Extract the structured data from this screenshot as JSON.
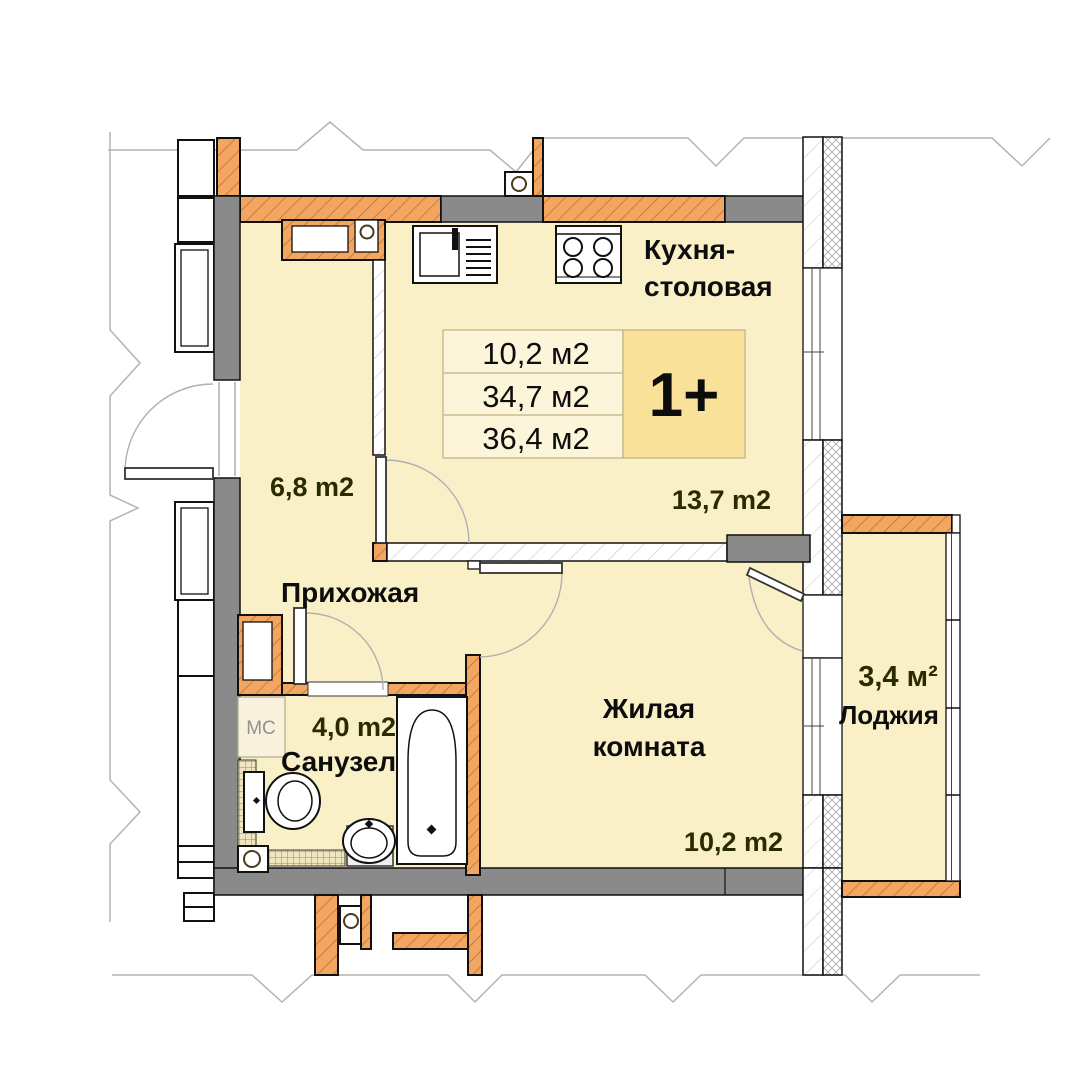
{
  "floor_plan": {
    "unit": {
      "badge": "1+",
      "stats": [
        "10,2 м2",
        "34,7 м2",
        "36,4 м2"
      ]
    },
    "rooms": {
      "kitchen_dining": {
        "name_line1": "Кухня-",
        "name_line2": "столовая",
        "area": "13,7 m2"
      },
      "hallway": {
        "name": "Прихожая",
        "area": "6,8 m2"
      },
      "bathroom": {
        "name": "Санузел",
        "area": "4,0 m2"
      },
      "living_room": {
        "name_line1": "Жилая",
        "name_line2": "комната",
        "area": "10,2 m2"
      },
      "loggia": {
        "name": "Лоджия",
        "area": "3,4 м²"
      }
    },
    "annotations": {
      "washing_machine": "МС"
    }
  },
  "colors": {
    "room_fill": "#FAF0C8",
    "table_cell": "#FCF5DA",
    "badge_cell": "#FAE199",
    "table_border": "#C9BD8F",
    "wall_orange": "#F3A562",
    "wall_orange_hatch": "#B5762F",
    "wall_gray": "#8A8A8A",
    "outline": "#111111",
    "area_color": "#2B2B00",
    "label_color": "#0D0D0D",
    "mc_color": "#909090",
    "arc_color": "#B0B0B0",
    "break_color": "#B3B3B3"
  }
}
